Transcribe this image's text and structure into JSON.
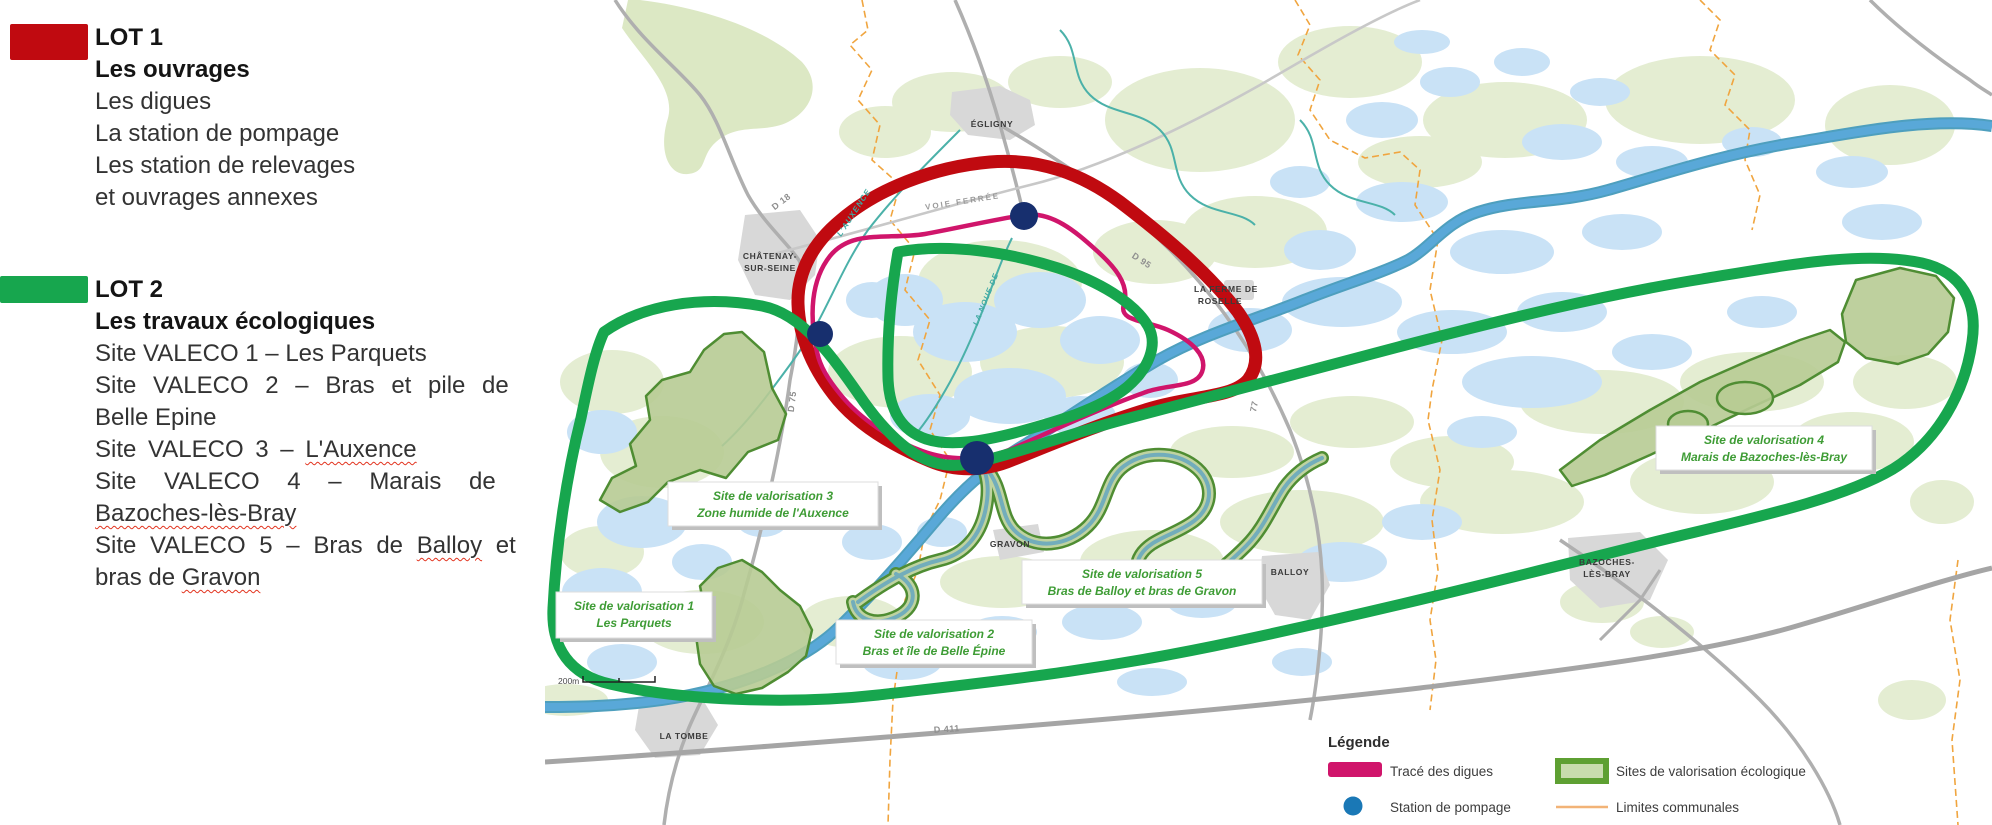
{
  "panel": {
    "lot1": {
      "title": "LOT 1",
      "subtitle": "Les ouvrages",
      "l1": "Les digues",
      "l2": "La station de pompage",
      "l3": "Les station de relevages",
      "l4": "et ouvrages annexes"
    },
    "lot2": {
      "title": "LOT 2",
      "subtitle": "Les travaux écologiques",
      "s1": "Site VALECO 1 – Les Parquets",
      "s2a": "Site VALECO 2 – Bras et pile de",
      "s2b": "Belle Epine",
      "s3a": "Site VALECO  3 – ",
      "s3b": "L'Auxence",
      "s4a": "Site VALECO 4 – Marais de",
      "s4b": "Bazoches-lès-Bray",
      "s5a": "Site VALECO 5 – Bras de ",
      "s5b": "Balloy",
      "s5c": " et",
      "s5d": "bras de ",
      "s5e": "Gravon"
    }
  },
  "map": {
    "towns": {
      "egligny": "ÉGLIGNY",
      "chatenay1": "CHÂTENAY-",
      "chatenay2": "SUR-SEINE",
      "ferme1": "LA FERME DE",
      "ferme2": "ROSELLE",
      "gravon": "GRAVON",
      "balloy": "BALLOY",
      "bazoches1": "BAZOCHES-",
      "bazoches2": "LÈS-BRAY",
      "latombe": "LA TOMBE"
    },
    "roads": {
      "d18": "D 18",
      "d95": "D 95",
      "d75": "D 75",
      "d411": "D 411",
      "d77": "77",
      "voie_ferree": "VOIE FERRÉE"
    },
    "rivers": {
      "auxence": "L'AUXENCE",
      "noue": "LA NOUE DE"
    },
    "sites": [
      {
        "l1": "Site de valorisation 1",
        "l2": "Les Parquets"
      },
      {
        "l1": "Site de valorisation 2",
        "l2": "Bras et île de Belle Épine"
      },
      {
        "l1": "Site de valorisation 3",
        "l2": "Zone humide de l'Auxence"
      },
      {
        "l1": "Site de valorisation 4",
        "l2": "Marais de Bazoches-lès-Bray"
      },
      {
        "l1": "Site de valorisation 5",
        "l2": "Bras de Balloy et bras de Gravon"
      }
    ],
    "scale": "200m"
  },
  "legend": {
    "title": "Légende",
    "digues": "Tracé des digues",
    "sites": "Sites de valorisation écologique",
    "pompage": "Station de pompage",
    "limites": "Limites communales"
  },
  "colors": {
    "lot1_red": "#C00A10",
    "lot2_green": "#17A64E",
    "digue_pink": "#D0156B",
    "station_navy": "#172F6E",
    "legend_blue": "#1A78B6",
    "limites_orange": "#F0A53F",
    "site_fill": "#B7CB93",
    "site_stroke": "#4F8D33",
    "water": "#C9E2F6",
    "field": "#E4EDD2",
    "seine": "#59A8D8"
  }
}
